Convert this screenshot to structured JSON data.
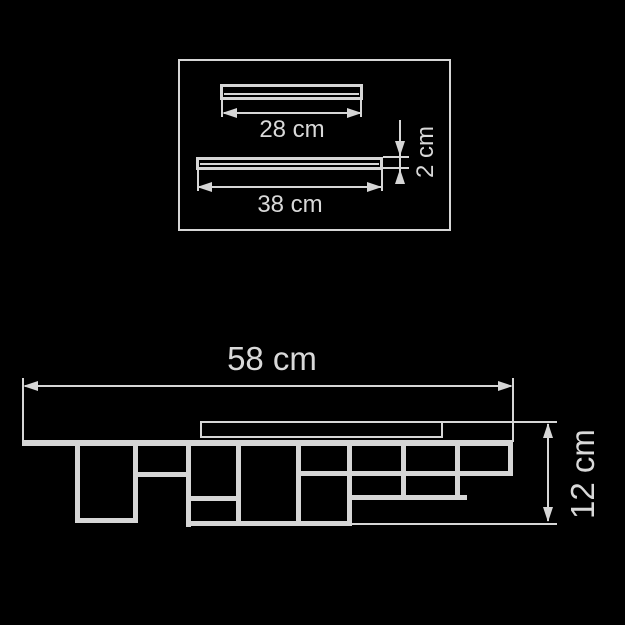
{
  "colors": {
    "background": "#000000",
    "line": "#d6d6d6",
    "text": "#d9d9d9"
  },
  "drawing": {
    "top_view": {
      "upper_bar_width_label": "28 cm",
      "lower_bar_width_label": "38 cm",
      "bar_thickness_label": "2 cm"
    },
    "side_view": {
      "overall_width_label": "58 cm",
      "overall_height_label": "12 cm"
    }
  }
}
